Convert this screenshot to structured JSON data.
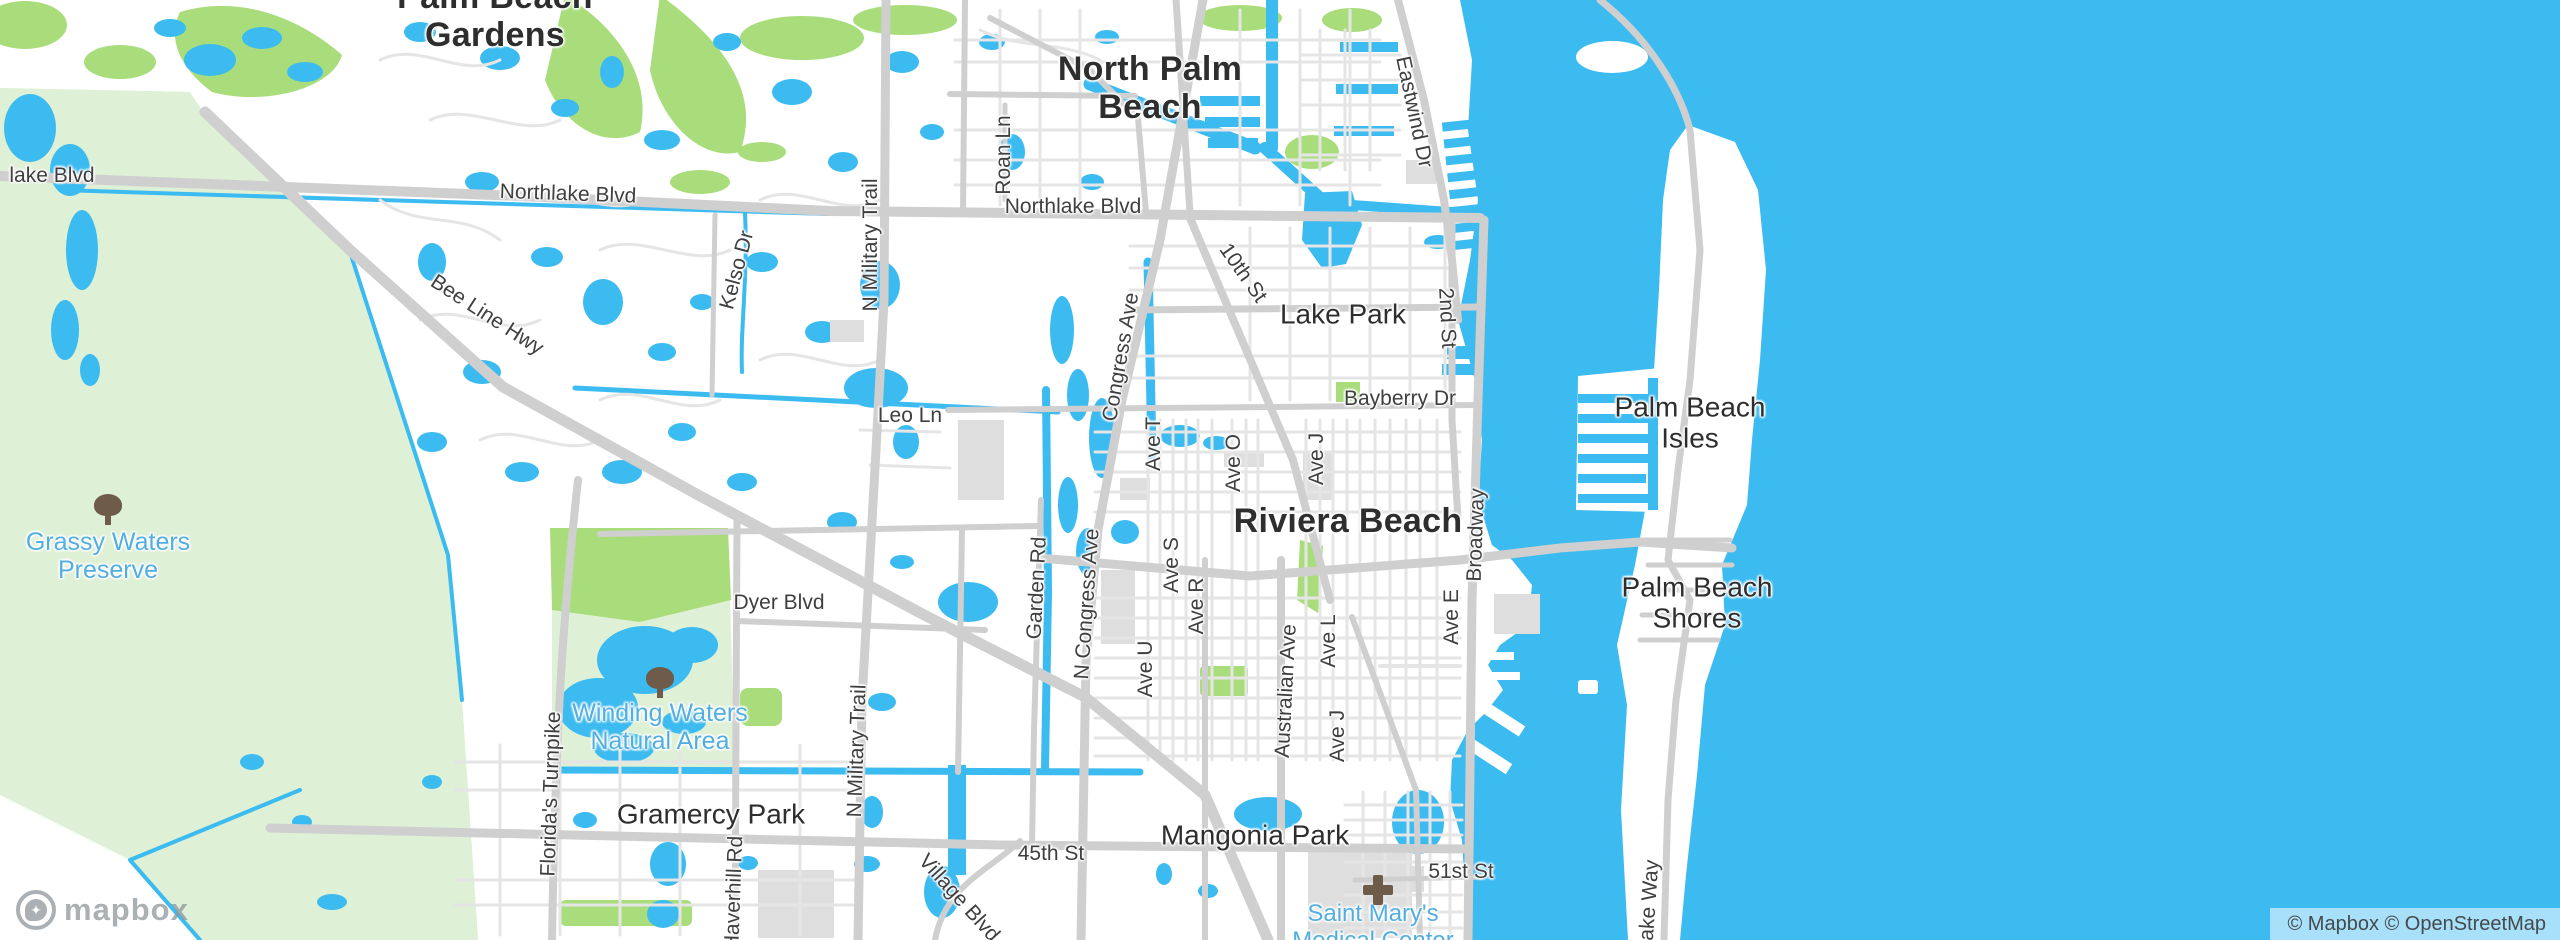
{
  "map": {
    "provider_logo_text": "mapbox",
    "attribution_text": "© Mapbox © OpenStreetMap",
    "colors": {
      "water": "#3CBBF0",
      "land": "#FFFFFF",
      "preserve_green": "#DEF0D6",
      "park_green": "#A9DD7C",
      "road_major": "#CFCFCF",
      "road_minor": "#E5E5E5",
      "building_gray": "#DEDEDE",
      "label_dark": "#2E2E2E",
      "label_road": "#3F3F3F",
      "label_green_poi": "#52AEE0",
      "icon_brown": "#6E5B49"
    },
    "city_labels": [
      {
        "text": "Palm Beach\nGardens",
        "x": 495,
        "y": 16,
        "rotate": 0
      },
      {
        "text": "North Palm\nBeach",
        "x": 1150,
        "y": 88,
        "rotate": 0
      },
      {
        "text": "Riviera Beach",
        "x": 1348,
        "y": 521,
        "rotate": 0
      }
    ],
    "town_labels": [
      {
        "text": "Lake Park",
        "x": 1343,
        "y": 314,
        "rotate": 0
      },
      {
        "text": "Palm Beach\nIsles",
        "x": 1690,
        "y": 423,
        "rotate": 0
      },
      {
        "text": "Palm Beach\nShores",
        "x": 1697,
        "y": 603,
        "rotate": 0
      },
      {
        "text": "Gramercy Park",
        "x": 711,
        "y": 814,
        "rotate": 0
      },
      {
        "text": "Mangonia Park",
        "x": 1255,
        "y": 835,
        "rotate": 0
      }
    ],
    "road_labels": [
      {
        "text": "lake Blvd",
        "x": 52,
        "y": 176,
        "rotate": 0
      },
      {
        "text": "Northlake Blvd",
        "x": 568,
        "y": 194,
        "rotate": 2
      },
      {
        "text": "Northlake Blvd",
        "x": 1073,
        "y": 207,
        "rotate": 0
      },
      {
        "text": "Bee Line Hwy",
        "x": 487,
        "y": 315,
        "rotate": 33
      },
      {
        "text": "Kelso Dr",
        "x": 737,
        "y": 270,
        "rotate": -75
      },
      {
        "text": "Roan Ln",
        "x": 1004,
        "y": 155,
        "rotate": -90
      },
      {
        "text": "N Military Trail",
        "x": 871,
        "y": 245,
        "rotate": -90
      },
      {
        "text": "Eastwind Dr",
        "x": 1414,
        "y": 112,
        "rotate": 78
      },
      {
        "text": "10th St",
        "x": 1243,
        "y": 273,
        "rotate": 55
      },
      {
        "text": "2nd St",
        "x": 1447,
        "y": 318,
        "rotate": 87
      },
      {
        "text": "Bayberry Dr",
        "x": 1400,
        "y": 399,
        "rotate": 0
      },
      {
        "text": "Leo Ln",
        "x": 910,
        "y": 416,
        "rotate": 0
      },
      {
        "text": "Congress Ave",
        "x": 1121,
        "y": 357,
        "rotate": -80
      },
      {
        "text": "Ave T",
        "x": 1154,
        "y": 444,
        "rotate": -90
      },
      {
        "text": "Ave O",
        "x": 1234,
        "y": 463,
        "rotate": -90
      },
      {
        "text": "Ave J",
        "x": 1317,
        "y": 459,
        "rotate": -90
      },
      {
        "text": "Broadway",
        "x": 1476,
        "y": 535,
        "rotate": -88
      },
      {
        "text": "Garden Rd",
        "x": 1037,
        "y": 588,
        "rotate": -87
      },
      {
        "text": "N Congress Ave",
        "x": 1087,
        "y": 604,
        "rotate": -86
      },
      {
        "text": "Ave S",
        "x": 1172,
        "y": 565,
        "rotate": -90
      },
      {
        "text": "Ave R",
        "x": 1197,
        "y": 606,
        "rotate": -90
      },
      {
        "text": "Ave U",
        "x": 1146,
        "y": 669,
        "rotate": -90
      },
      {
        "text": "Australian Ave",
        "x": 1286,
        "y": 691,
        "rotate": -87
      },
      {
        "text": "Ave L",
        "x": 1329,
        "y": 641,
        "rotate": -90
      },
      {
        "text": "Ave J",
        "x": 1338,
        "y": 736,
        "rotate": -90
      },
      {
        "text": "Ave E",
        "x": 1452,
        "y": 617,
        "rotate": -90
      },
      {
        "text": "Dyer Blvd",
        "x": 779,
        "y": 603,
        "rotate": 0
      },
      {
        "text": "Florida's Turnpike",
        "x": 551,
        "y": 794,
        "rotate": -88
      },
      {
        "text": "N Military Trail",
        "x": 857,
        "y": 751,
        "rotate": -88
      },
      {
        "text": "Haverhill Rd",
        "x": 734,
        "y": 893,
        "rotate": -88
      },
      {
        "text": "Village Blvd",
        "x": 959,
        "y": 898,
        "rotate": 48
      },
      {
        "text": "45th St",
        "x": 1051,
        "y": 854,
        "rotate": 0
      },
      {
        "text": "51st St",
        "x": 1461,
        "y": 872,
        "rotate": 0
      },
      {
        "text": "Lake Way",
        "x": 1649,
        "y": 906,
        "rotate": -86
      }
    ],
    "area_labels": [
      {
        "text": "Grassy Waters\nPreserve",
        "x": 108,
        "y": 556,
        "rotate": 0,
        "icon": "tree-icon",
        "icon_x": 108,
        "icon_y": 511
      },
      {
        "text": "Winding Waters\nNatural Area",
        "x": 660,
        "y": 727,
        "rotate": 0,
        "icon": "tree-icon",
        "icon_x": 660,
        "icon_y": 684
      }
    ],
    "poi_labels": [
      {
        "text": "Saint Mary's\nMedical Center",
        "x": 1373,
        "y": 928,
        "rotate": 0,
        "icon": "hospital-icon",
        "icon_x": 1378,
        "icon_y": 890
      }
    ]
  }
}
